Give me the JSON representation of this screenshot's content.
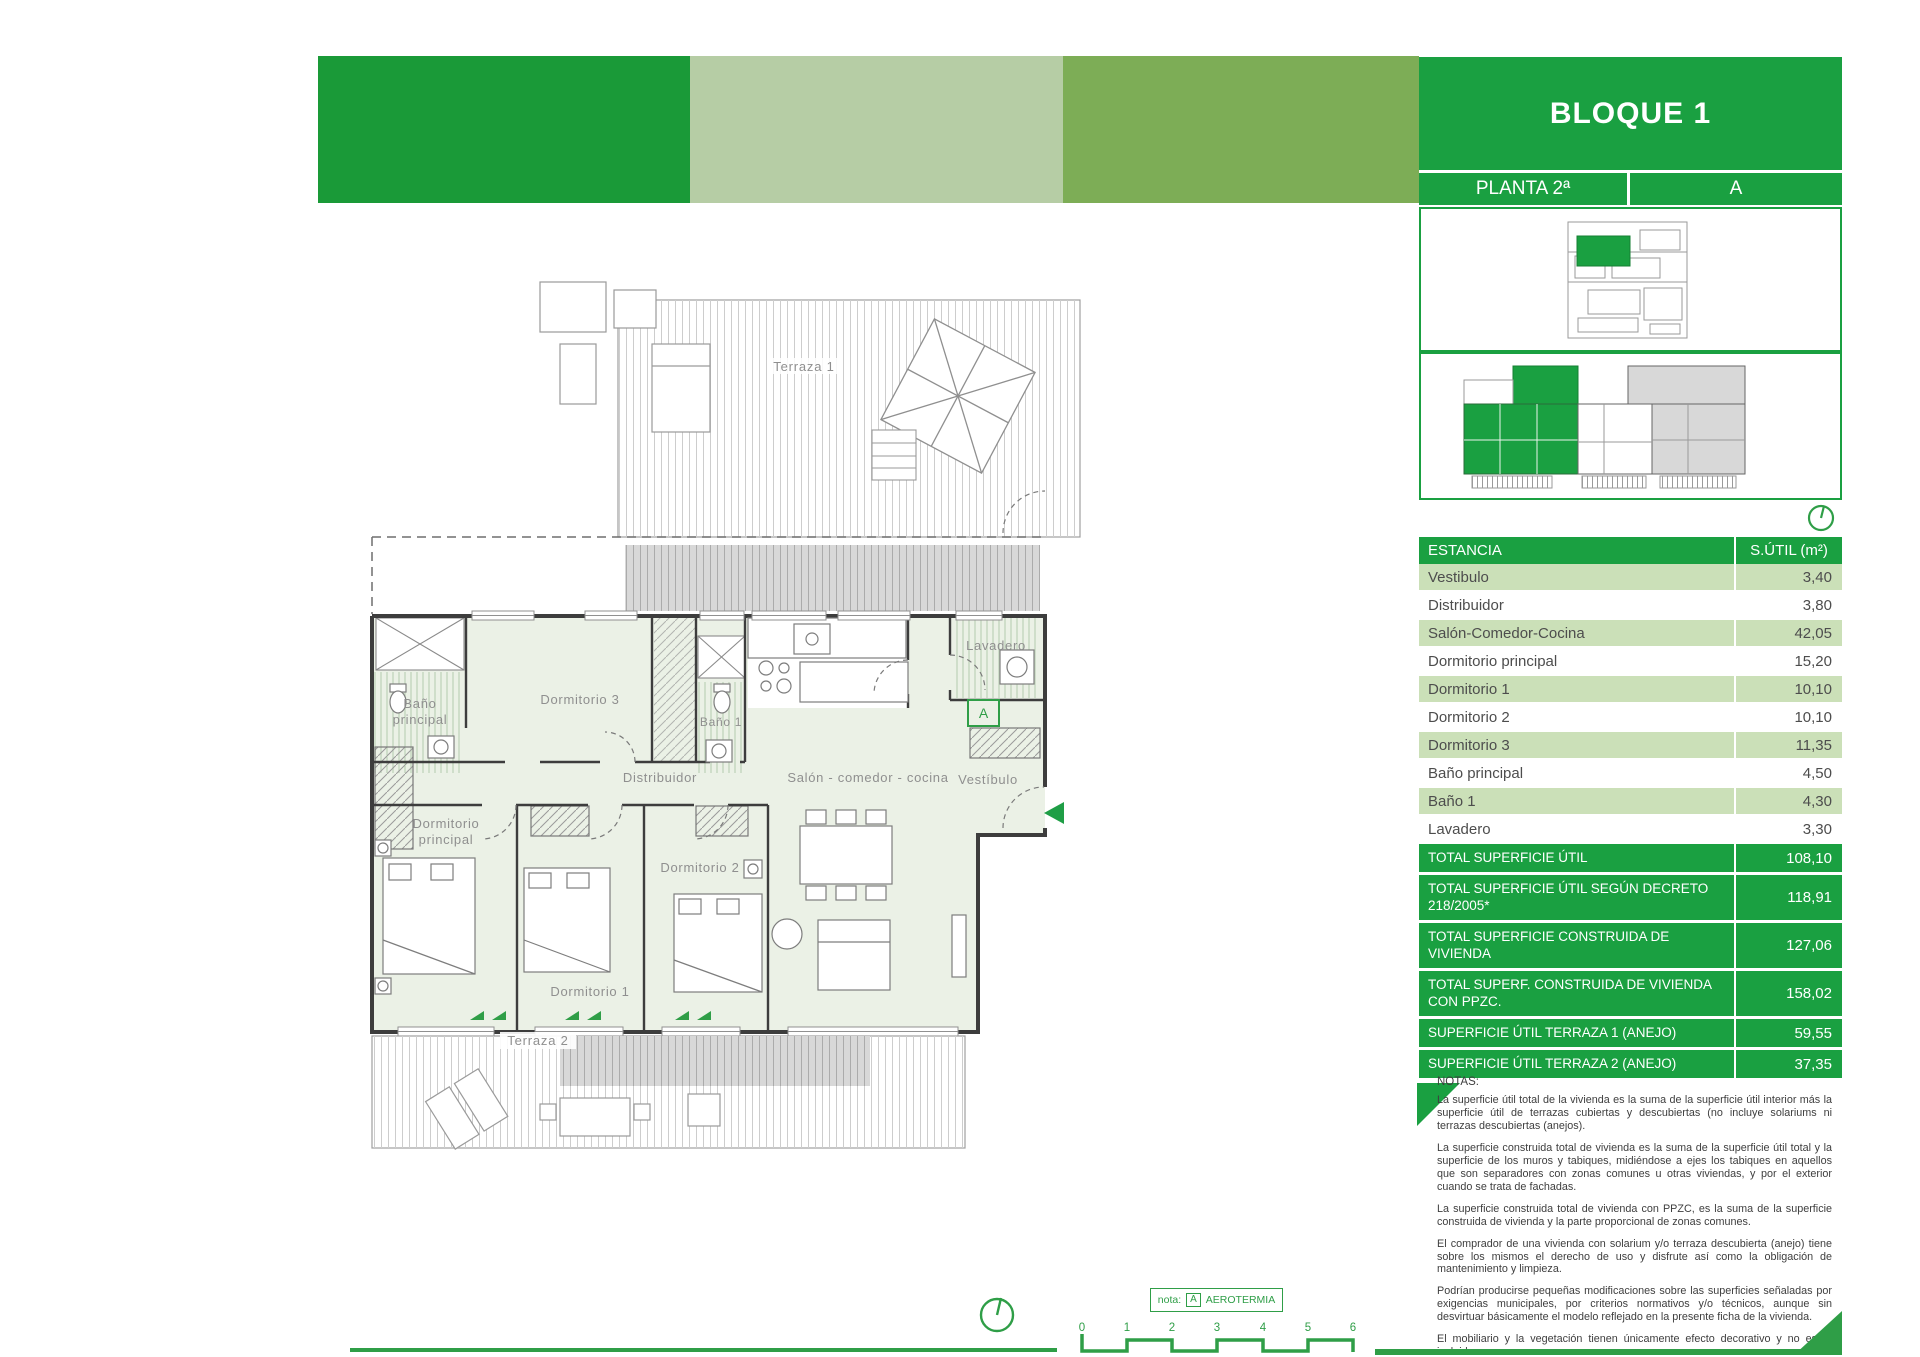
{
  "header": {
    "title": "BLOQUE 1",
    "planta": "PLANTA 2ª",
    "unidad": "A"
  },
  "table": {
    "col_estancia": "ESTANCIA",
    "col_sutil": "S.ÚTIL (m²)",
    "rows": [
      {
        "label": "Vestibulo",
        "value": "3,40"
      },
      {
        "label": "Distribuidor",
        "value": "3,80"
      },
      {
        "label": "Salón-Comedor-Cocina",
        "value": "42,05"
      },
      {
        "label": "Dormitorio principal",
        "value": "15,20"
      },
      {
        "label": "Dormitorio 1",
        "value": "10,10"
      },
      {
        "label": "Dormitorio 2",
        "value": "10,10"
      },
      {
        "label": "Dormitorio 3",
        "value": "11,35"
      },
      {
        "label": "Baño principal",
        "value": "4,50"
      },
      {
        "label": "Baño 1",
        "value": "4,30"
      },
      {
        "label": "Lavadero",
        "value": "3,30"
      }
    ],
    "totals": [
      {
        "label": "TOTAL SUPERFICIE ÚTIL",
        "value": "108,10",
        "lines": 1
      },
      {
        "label": "TOTAL SUPERFICIE ÚTIL SEGÚN DECRETO 218/2005*",
        "value": "118,91",
        "lines": 2
      },
      {
        "label": "TOTAL SUPERFICIE CONSTRUIDA DE VIVIENDA",
        "value": "127,06",
        "lines": 2
      },
      {
        "label": "TOTAL SUPERF. CONSTRUIDA DE VIVIENDA CON PPZC.",
        "value": "158,02",
        "lines": 2
      },
      {
        "label": "SUPERFICIE ÚTIL TERRAZA 1 (ANEJO)",
        "value": "59,55",
        "lines": 1
      },
      {
        "label": "SUPERFICIE ÚTIL TERRAZA 2 (ANEJO)",
        "value": "37,35",
        "lines": 1
      }
    ]
  },
  "notas": {
    "title": "NOTAS:",
    "paragraphs": [
      "La superficie útil total de la vivienda es la suma de la superficie útil interior más la superficie útil de terrazas cubiertas y descubiertas (no incluye solariums ni terrazas descubiertas (anejos).",
      "La superficie construida total de vivienda es la suma de la superficie útil total y la superficie de los muros y tabiques, midiéndose a ejes los tabiques en aquellos que son separadores con zonas comunes u otras viviendas, y por el exterior cuando se trata de fachadas.",
      "La superficie construida total de vivienda con PPZC, es la suma de la superficie construida de vivienda y la parte proporcional de zonas comunes.",
      "El comprador de una vivienda con solarium y/o terraza descubierta (anejo) tiene sobre los mismos el derecho de uso y disfrute así como la obligación de mantenimiento y limpieza.",
      "Podrían producirse pequeñas modificaciones sobre las superficies señaladas por exigencias municipales, por criterios normativos y/o técnicos, aunque sin desvirtuar básicamente el modelo reflejado en la presente ficha de la vivienda.",
      "El mobiliario y la vegetación tienen únicamente efecto decorativo y no están incluidos",
      "(*) Anexo 1. Reglamento de información al consumidor en la compraventa y arrendamiento de viviendas en Andalucia"
    ]
  },
  "plan": {
    "labels": {
      "terraza1": "Terraza 1",
      "terraza2": "Terraza 2",
      "bano_principal_1": "Baño",
      "bano_principal_2": "principal",
      "dormitorio3": "Dormitorio 3",
      "bano1": "Baño 1",
      "lavadero": "Lavadero",
      "distribuidor": "Distribuidor",
      "salon": "Salón - comedor - cocina",
      "vestibulo": "Vestíbulo",
      "dormitorio_principal_1": "Dormitorio",
      "dormitorio_principal_2": "principal",
      "dormitorio1": "Dormitorio 1",
      "dormitorio2": "Dormitorio 2",
      "badge_a": "A"
    }
  },
  "nota_box": {
    "prefix": "nota:",
    "badge": "A",
    "label": "AEROTERMIA"
  },
  "scalebar": {
    "ticks": [
      "0",
      "1",
      "2",
      "3",
      "4",
      "5",
      "6"
    ]
  },
  "colors": {
    "green": "#1aa041",
    "band_dark": "#1a9a38",
    "band_pale": "#b6cda5",
    "band_olive": "#7dad56",
    "row_green": "#cbe0b8"
  }
}
